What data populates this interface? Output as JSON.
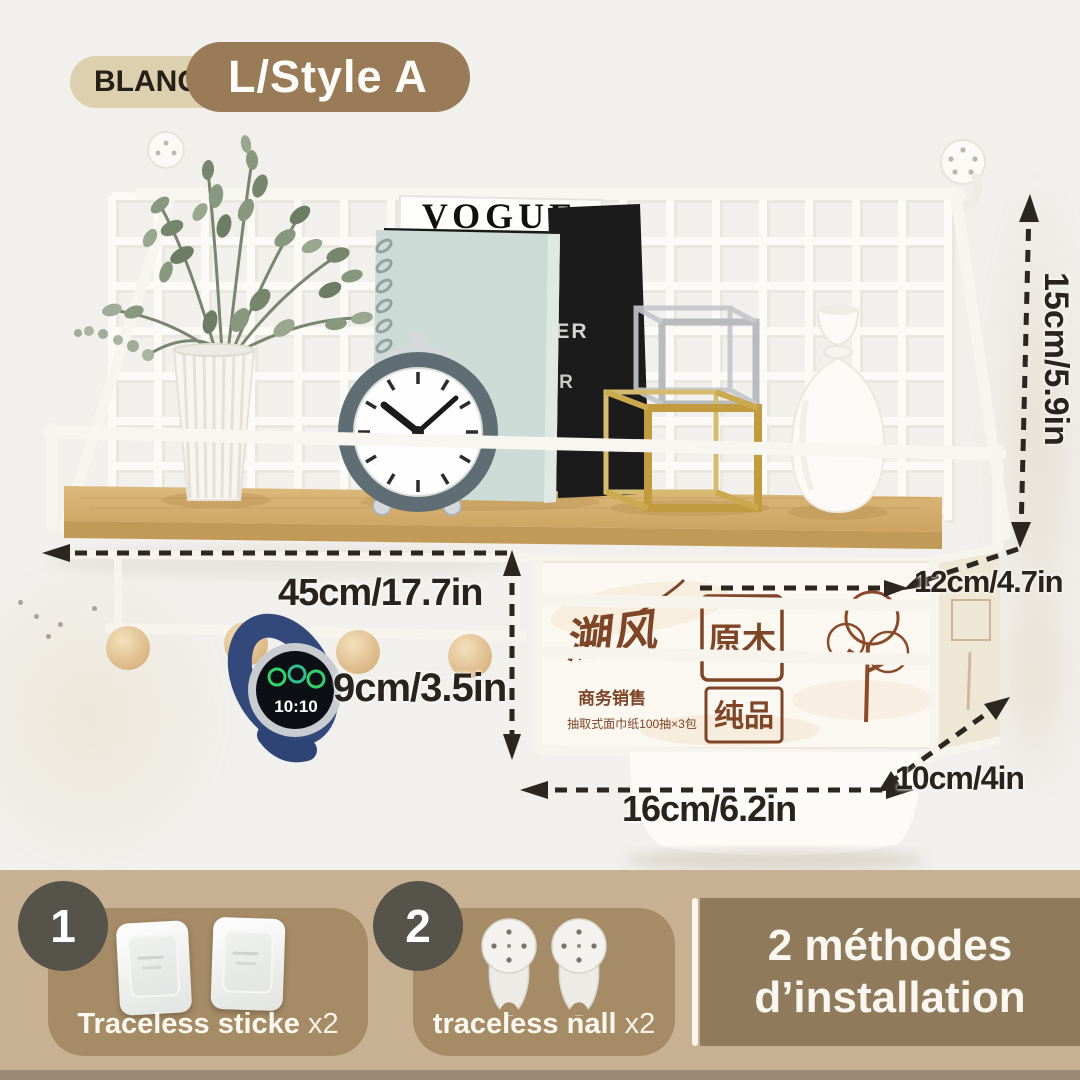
{
  "badges": {
    "color_label": "BLANC",
    "variant_label": "L/Style A"
  },
  "dims": {
    "width": "45cm/17.7in",
    "hook_drop": "9cm/3.5in",
    "back_height": "15cm/5.9in",
    "shelf_depth": "12cm/4.7in",
    "basket_width": "16cm/6.2in",
    "basket_depth": "10cm/4in"
  },
  "product": {
    "magazine1": "VOGUE",
    "magazine2": "VOGUE",
    "spine1": "ER",
    "spine2": "R",
    "watch_time": "10:10",
    "tissue": {
      "brand": "溯风",
      "seal_top": "原木",
      "seal_bottom": "纯品",
      "line1": "商务销售",
      "line2": "抽取式面巾纸100抽×3包"
    }
  },
  "installation": {
    "title1": "2 méthodes",
    "title2": "d’installation",
    "steps": [
      {
        "number": "1",
        "label": "Traceless sticke",
        "count": "x2"
      },
      {
        "number": "2",
        "label": "traceless nall",
        "count": "x2"
      }
    ]
  },
  "colors": {
    "annotation": "#2b2620",
    "badge_color_bg": "#ddd0ae",
    "badge_variant_bg": "#9a7b57",
    "bottom_strip_bg": "#c8b192",
    "method_card_bg": "#a58b66",
    "install_box_bg": "#8f7b5c",
    "step_circle_bg": "#56544a",
    "wood": "#d3ab6e",
    "grid_white": "#fbfaf7"
  }
}
